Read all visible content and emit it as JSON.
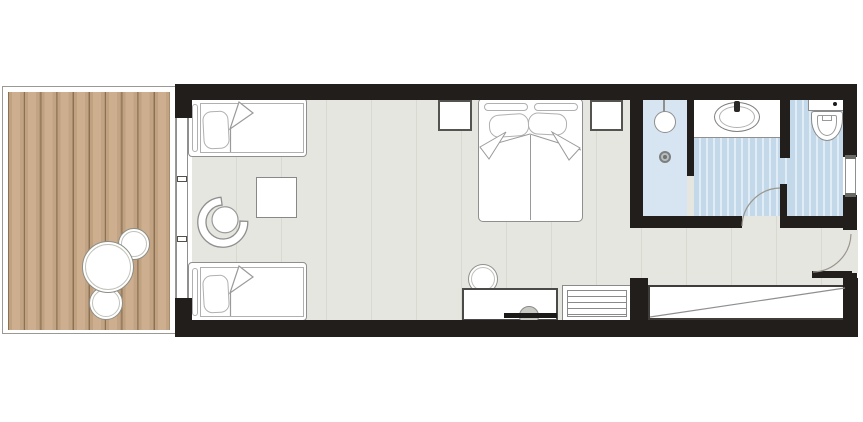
{
  "title": "hotel-room-floor-plan",
  "palette": {
    "wall": "#211e1c",
    "bedroom_floor": "#e5e6df",
    "floor_seam": "#d8dacf",
    "deck_plank": "#cdaf8f",
    "deck_plank_seam": "#8a7156",
    "bath_tile": "#c3d8e9",
    "bath_tile_line": "#e0edf6",
    "shower_floor": "#d6e5f1",
    "furniture_fill": "#ffffff",
    "furniture_line": "#8f8f8f",
    "door_arc": "#9a968e"
  },
  "rooms": {
    "terrace": "Terrace deck",
    "bedroom": "Bedroom",
    "bathroom": "Bathroom",
    "entry": "Entry corridor"
  },
  "furniture": {
    "deck_table": "Round deck table",
    "deck_chair_upper": "Deck chair",
    "deck_chair_lower": "Deck chair",
    "patio_door": "Sliding patio door",
    "single_bed_top": "Single bed",
    "single_bed_bottom": "Single bed",
    "double_bed": "Double bed",
    "nightstand_left": "Nightstand",
    "nightstand_right": "Nightstand",
    "side_table": "Side table",
    "armchair": "Armchair",
    "desk": "Desk / TV console",
    "desk_chair": "Desk chair",
    "tv": "Television",
    "luggage_rack": "Luggage bench",
    "wardrobe": "Wardrobe",
    "shower": "Shower",
    "shower_drain": "Shower drain",
    "vanity": "Vanity counter",
    "sink": "Washbasin",
    "toilet": "Toilet",
    "bathroom_door": "Bathroom door",
    "entry_door": "Entrance door",
    "window": "Window"
  }
}
